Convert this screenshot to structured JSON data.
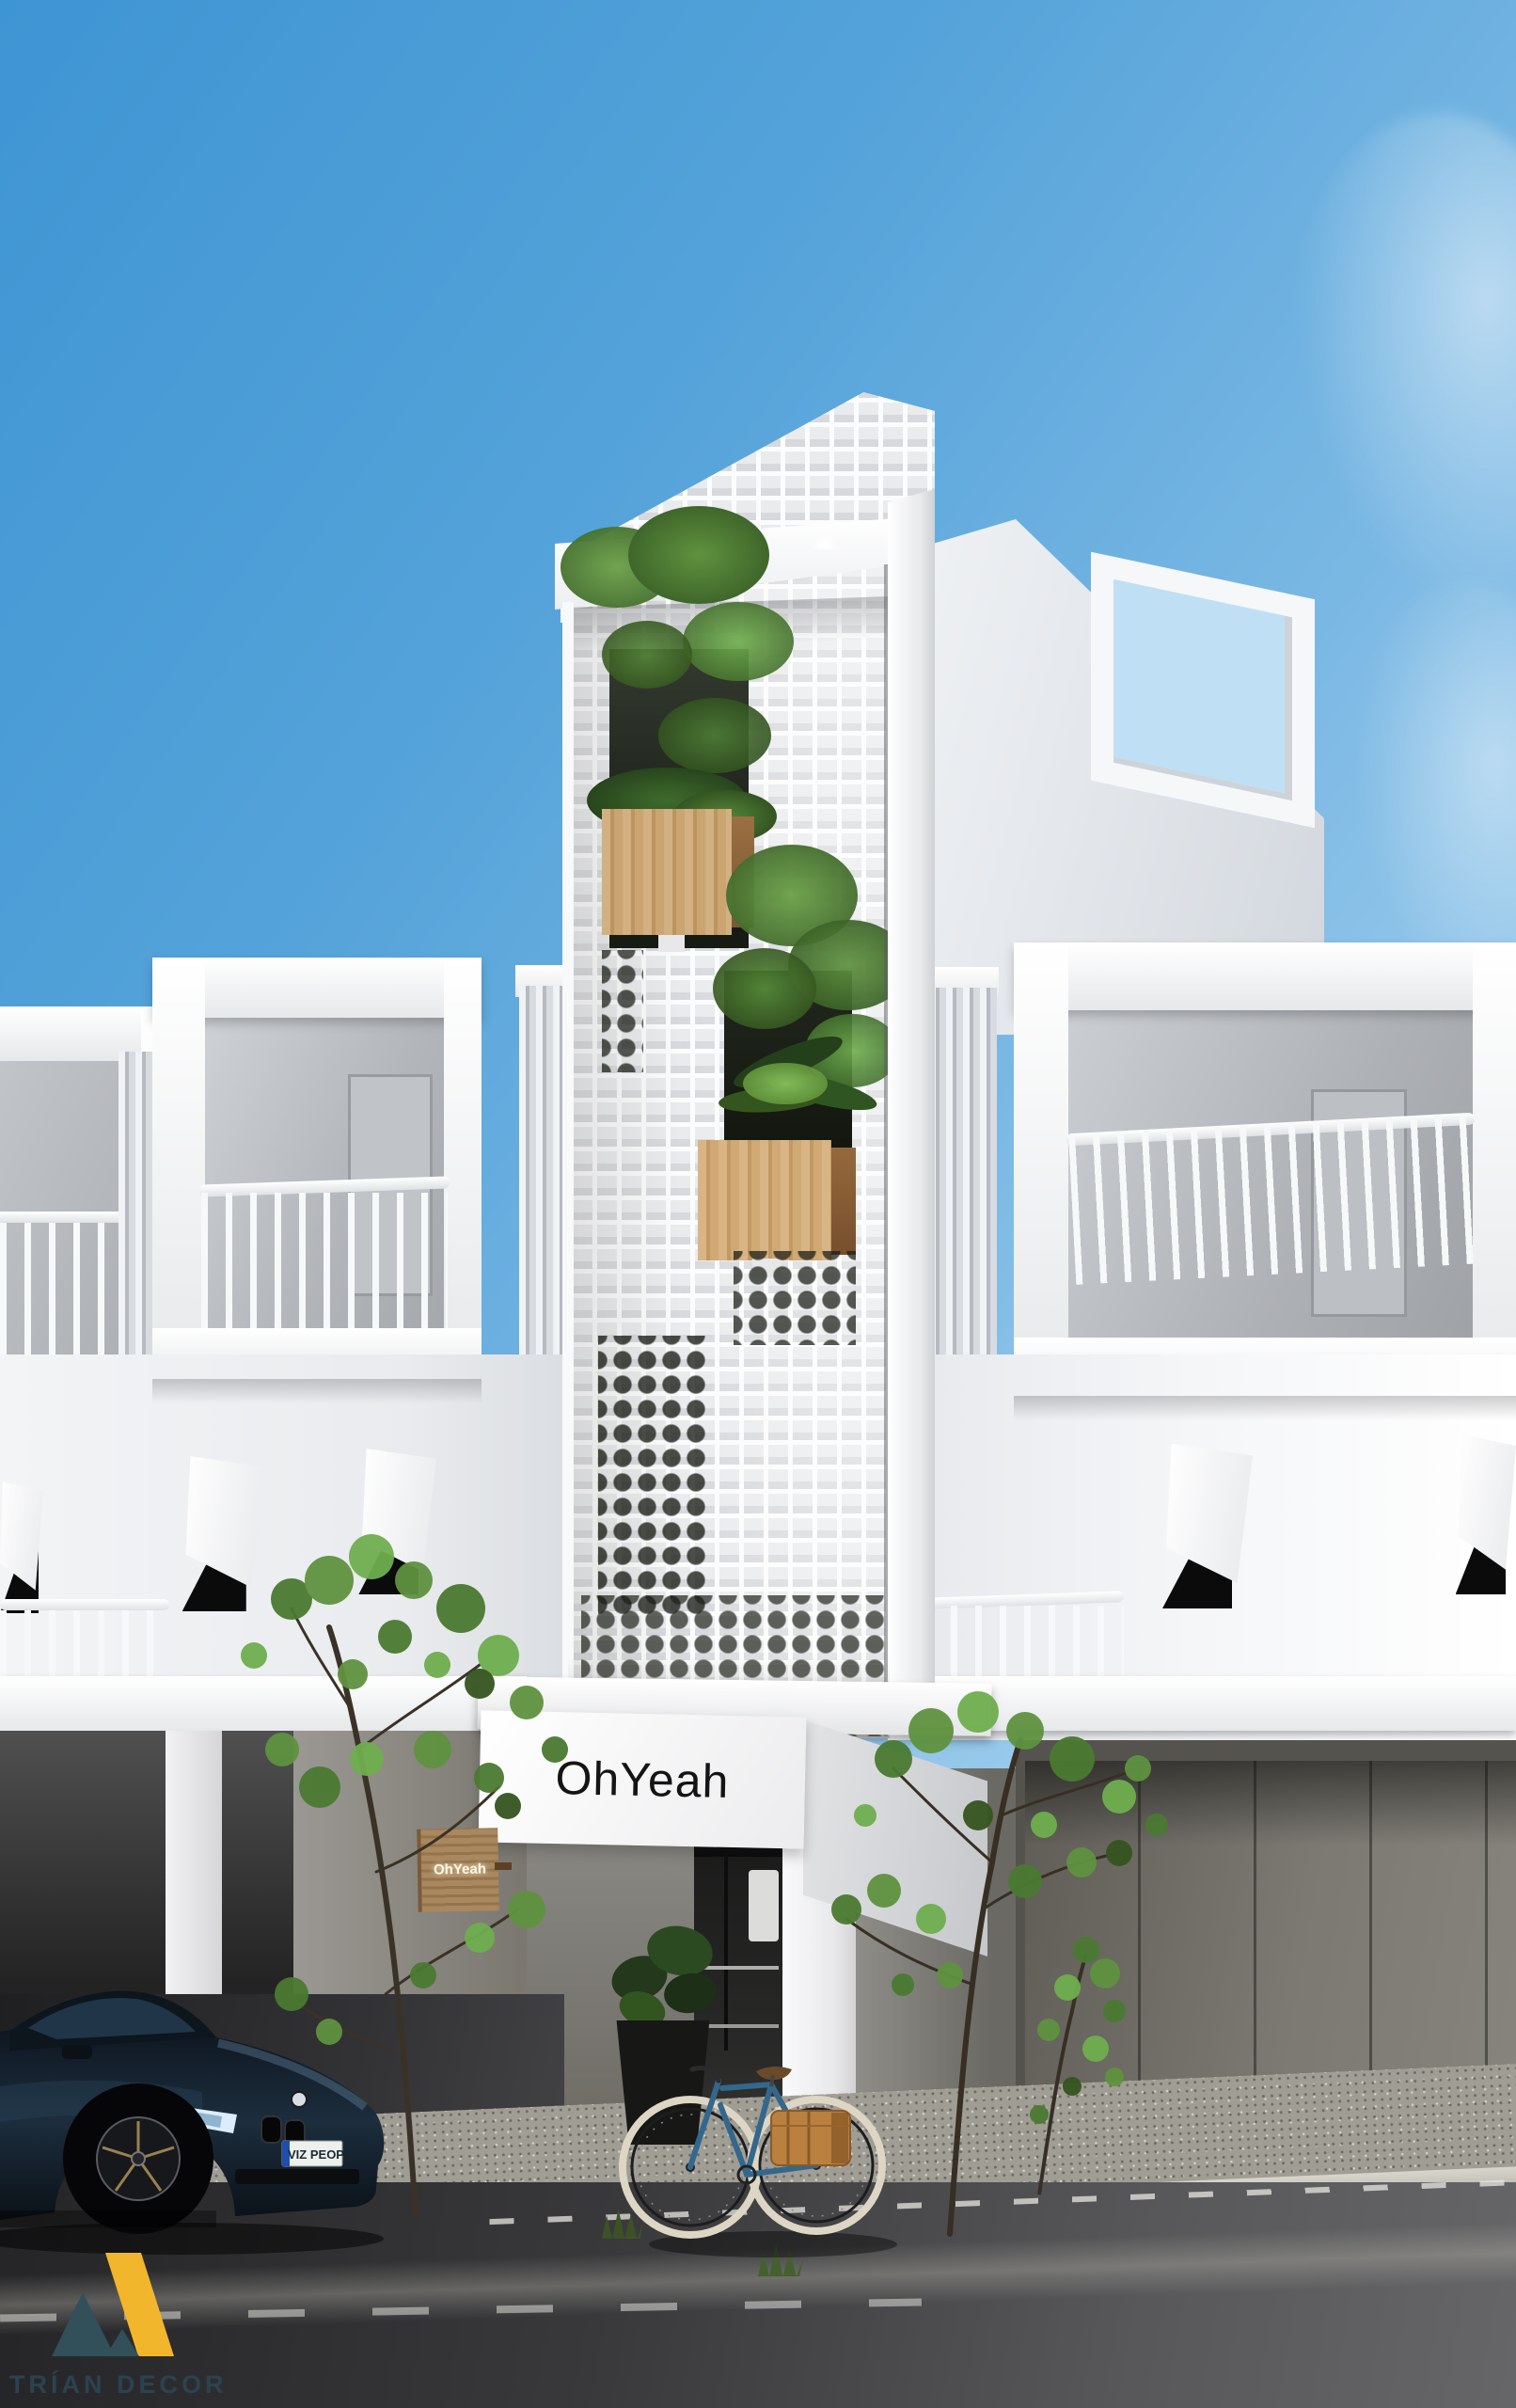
{
  "scene": {
    "description": "Exterior daylight render of a narrow white shophouse with perforated breeze-block facade, flanked by white townhouses with box balconies",
    "watermark": "TRÍAN DECOR"
  },
  "signs": {
    "main": "OhYeah",
    "hanging": "OhYeah"
  },
  "vehicles": {
    "car_license_plate": "VIZ PEOP"
  },
  "palette": {
    "sky_top": "#3e95d3",
    "sky_horizon": "#b8dcf3",
    "facade_white": "#f4f5f7",
    "facade_shadow": "#c9ccd1",
    "wood_planter": "#c8a26e",
    "foliage_green": "#5c8f3f",
    "asphalt_gray": "#4a4a4c",
    "car_blue": "#13202e",
    "bike_blue": "#2f6a8f",
    "pannier_brown": "#b9803f",
    "logo_yellow": "#f2b62c",
    "logo_slate": "#2c4350",
    "sign_text": "#141414"
  }
}
